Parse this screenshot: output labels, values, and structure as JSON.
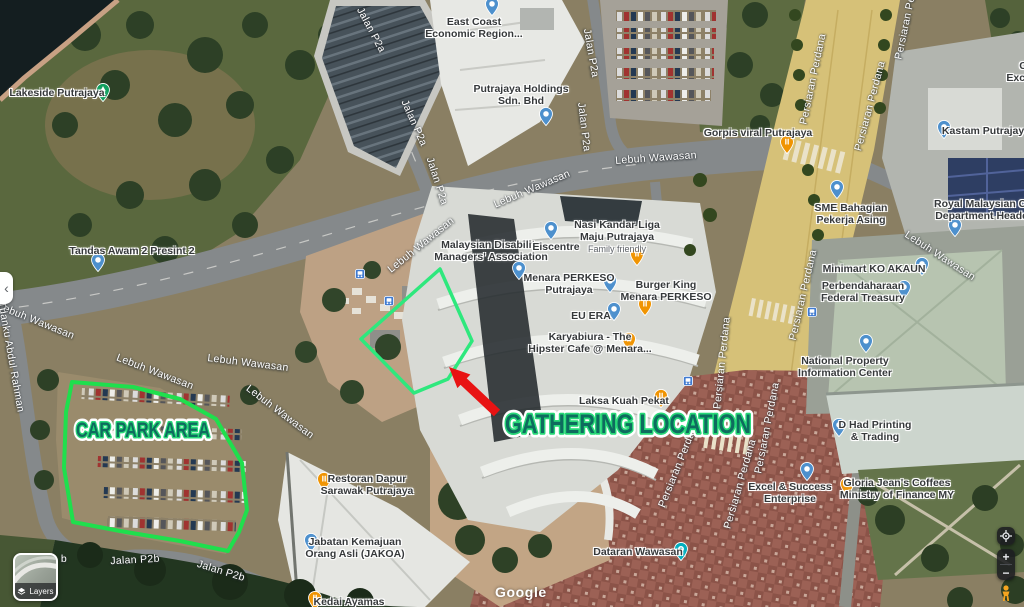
{
  "attribution": {
    "watermark": "Google"
  },
  "controls": {
    "layers": {
      "label": "Layers"
    },
    "collapse_glyph": "‹",
    "zoom_in_label": "+",
    "zoom_out_label": "−"
  },
  "annotations": {
    "car_park_label": "CAR PARK AREA",
    "gathering_label": "GATHERING LOCATION",
    "colors": {
      "car_park_outline": "#1fdf4d",
      "gathering_outline": "#2ee87d",
      "arrow_red": "#e81313",
      "label_fill": "#0e6b5e",
      "label_stroke": "#27d877"
    }
  },
  "map": {
    "pois": [
      {
        "name": "lakeside-putrajaya",
        "lines": [
          "Lakeside Putrajaya"
        ],
        "x": 57,
        "y": 87,
        "pin": "tree",
        "pin_x": 103,
        "pin_y": 94
      },
      {
        "name": "tandas-awam-2-presint-2",
        "lines": [
          "Tandas Awam 2 Presint 2"
        ],
        "x": 132,
        "y": 245,
        "pin": "blue",
        "pin_x": 98,
        "pin_y": 264
      },
      {
        "name": "east-coast-economic-region",
        "lines": [
          "East Coast",
          "Economic Region..."
        ],
        "x": 474,
        "y": 16,
        "pin": "blue",
        "pin_x": 492,
        "pin_y": 8
      },
      {
        "name": "putrajaya-holdings",
        "lines": [
          "Putrajaya Holdings",
          "Sdn. Bhd"
        ],
        "x": 521,
        "y": 83,
        "pin": "blue",
        "pin_x": 546,
        "pin_y": 118
      },
      {
        "name": "gorpis-viral-putrajaya",
        "lines": [
          "Gorpis viral Putrajaya"
        ],
        "x": 758,
        "y": 127,
        "pin": "food",
        "pin_x": 787,
        "pin_y": 146
      },
      {
        "name": "sme-bahagian-pekerja-asing",
        "lines": [
          "SME Bahagian",
          "Pekerja Asing"
        ],
        "x": 851,
        "y": 202,
        "pin": "blue",
        "pin_x": 837,
        "pin_y": 191
      },
      {
        "name": "kastam-putrajaya",
        "lines": [
          "Kastam Putrajaya"
        ],
        "x": 986,
        "y": 125,
        "pin": "blue",
        "pin_x": 944,
        "pin_y": 131
      },
      {
        "name": "excise-partial",
        "lines": [
          "C",
          "Excise"
        ],
        "x": 1023,
        "y": 60,
        "pin": ""
      },
      {
        "name": "royal-malaysian-customs",
        "lines": [
          "Royal Malaysian Cust",
          "Department Headqua"
        ],
        "x": 988,
        "y": 198,
        "pin": "blue",
        "pin_x": 955,
        "pin_y": 229
      },
      {
        "name": "minimart-ko-akaun",
        "lines": [
          "Minimart KO AKAUN"
        ],
        "x": 874,
        "y": 263,
        "pin": "blue",
        "pin_x": 922,
        "pin_y": 268
      },
      {
        "name": "perbendaharaan-federal-treasury",
        "lines": [
          "Perbendaharaan",
          "Federal Treasury"
        ],
        "x": 863,
        "y": 280,
        "pin": "blue",
        "pin_x": 904,
        "pin_y": 291
      },
      {
        "name": "national-property-information-center",
        "lines": [
          "National Property",
          "Information Center"
        ],
        "x": 845,
        "y": 355,
        "pin": "blue",
        "pin_x": 866,
        "pin_y": 345
      },
      {
        "name": "malaysian-disability-managers-association",
        "lines": [
          "Malaysian Disability",
          "Managers' Association"
        ],
        "x": 491,
        "y": 239,
        "pin": "blue",
        "pin_x": 519,
        "pin_y": 272
      },
      {
        "name": "eiscentre",
        "lines": [
          "Eiscentre"
        ],
        "x": 556,
        "y": 241,
        "pin": "blue",
        "pin_x": 551,
        "pin_y": 232
      },
      {
        "name": "nasi-kandar-liga-maju-putrajaya",
        "lines": [
          "Nasi Kandar Liga",
          "Maju Putrajaya"
        ],
        "sub": "Family friendly",
        "x": 617,
        "y": 219,
        "pin": "food",
        "pin_x": 637,
        "pin_y": 258
      },
      {
        "name": "menara-perkeso-putrajaya",
        "lines": [
          "Menara PERKESO",
          "Putrajaya"
        ],
        "x": 569,
        "y": 272,
        "pin": "blue",
        "pin_x": 610,
        "pin_y": 285
      },
      {
        "name": "burger-king-menara-perkeso",
        "lines": [
          "Burger King",
          "Menara PERKESO"
        ],
        "x": 666,
        "y": 279,
        "pin": "food",
        "pin_x": 645,
        "pin_y": 308
      },
      {
        "name": "eu-era",
        "lines": [
          "EU ERA"
        ],
        "x": 591,
        "y": 310,
        "pin": "blue",
        "pin_x": 614,
        "pin_y": 313
      },
      {
        "name": "karyabiura-hipster-cafe",
        "lines": [
          "Karyabiura - The",
          "Hipster Cafe @ Menara..."
        ],
        "x": 590,
        "y": 331,
        "pin": "food",
        "pin_x": 629,
        "pin_y": 343
      },
      {
        "name": "laksa-kuah-pekat",
        "lines": [
          "Laksa Kuah Pekat"
        ],
        "x": 624,
        "y": 395,
        "pin": "food",
        "pin_x": 661,
        "pin_y": 400
      },
      {
        "name": "dataran-wawasan",
        "lines": [
          "Dataran Wawasan"
        ],
        "x": 638,
        "y": 546,
        "pin": "camera",
        "pin_x": 681,
        "pin_y": 553
      },
      {
        "name": "restoran-dapur-sarawak-putrajaya",
        "lines": [
          "Restoran Dapur",
          "Sarawak Putrajaya"
        ],
        "x": 367,
        "y": 473,
        "pin": "food",
        "pin_x": 324,
        "pin_y": 483
      },
      {
        "name": "jabatan-kemajuan-orang-asli-jakoa",
        "lines": [
          "Jabatan Kemajuan",
          "Orang Asli (JAKOA)"
        ],
        "x": 355,
        "y": 536,
        "pin": "blue",
        "pin_x": 311,
        "pin_y": 544
      },
      {
        "name": "kedai-ayamas",
        "lines": [
          "Kedai Ayamas"
        ],
        "x": 349,
        "y": 596,
        "pin": "food",
        "pin_x": 315,
        "pin_y": 602
      },
      {
        "name": "excel-success-enterprise",
        "lines": [
          "Excel & Success",
          "Enterprise"
        ],
        "x": 790,
        "y": 481,
        "pin": "blue",
        "pin_x": 807,
        "pin_y": 473
      },
      {
        "name": "gloria-jeans-coffees-ministry-of-finance",
        "lines": [
          "Gloria Jean's Coffees",
          "Ministry of Finance MY"
        ],
        "x": 897,
        "y": 477,
        "pin": "food",
        "pin_x": 847,
        "pin_y": 488
      },
      {
        "name": "d-had-printing-trading",
        "lines": [
          "D Had Printing",
          "& Trading"
        ],
        "x": 875,
        "y": 419,
        "pin": "blue",
        "pin_x": 839,
        "pin_y": 429
      }
    ],
    "road_labels": [
      {
        "text": "Jalan P2a",
        "x": 371,
        "y": 30,
        "rot": 62
      },
      {
        "text": "Jalan P2a",
        "x": 414,
        "y": 123,
        "rot": 66
      },
      {
        "text": "Jalan P2a",
        "x": 437,
        "y": 181,
        "rot": 72
      },
      {
        "text": "Jalan P2a",
        "x": 591,
        "y": 53,
        "rot": 80
      },
      {
        "text": "Jalan P2a",
        "x": 584,
        "y": 127,
        "rot": 83
      },
      {
        "text": "Lebuh Wawasan",
        "x": 36,
        "y": 321,
        "rot": 22
      },
      {
        "text": "Lebuh Wawasan",
        "x": 155,
        "y": 372,
        "rot": 21
      },
      {
        "text": "Lebuh Wawasan",
        "x": 248,
        "y": 363,
        "rot": 7
      },
      {
        "text": "Lebuh Wawasan",
        "x": 280,
        "y": 412,
        "rot": 37
      },
      {
        "text": "Lebuh Wawasan",
        "x": 421,
        "y": 245,
        "rot": -39
      },
      {
        "text": "Lebuh Wawasan",
        "x": 532,
        "y": 189,
        "rot": -23
      },
      {
        "text": "Lebuh Wawasan",
        "x": 656,
        "y": 158,
        "rot": -4
      },
      {
        "text": "Lebuh Wawasan",
        "x": 940,
        "y": 256,
        "rot": 33
      },
      {
        "text": "Persiaran Perdana",
        "x": 813,
        "y": 79,
        "rot": -78
      },
      {
        "text": "Persiaran Perdana",
        "x": 870,
        "y": 106,
        "rot": -75
      },
      {
        "text": "Persiaran Perdana",
        "x": 908,
        "y": 14,
        "rot": -78
      },
      {
        "text": "Persiaran Perdana",
        "x": 803,
        "y": 295,
        "rot": -77
      },
      {
        "text": "Persiaran Perdana",
        "x": 722,
        "y": 363,
        "rot": -84
      },
      {
        "text": "Persiaran Perdana",
        "x": 679,
        "y": 464,
        "rot": -68
      },
      {
        "text": "Persiaran Perdana",
        "x": 740,
        "y": 484,
        "rot": -74
      },
      {
        "text": "Persiaran Perdana",
        "x": 767,
        "y": 428,
        "rot": -79
      },
      {
        "text": "Tuanku Abdul Rahman",
        "x": 11,
        "y": 357,
        "rot": 80
      },
      {
        "text": "Jalan P2b",
        "x": 135,
        "y": 560,
        "rot": -3
      },
      {
        "text": "Jalan P2b",
        "x": 221,
        "y": 571,
        "rot": 17
      },
      {
        "text": "b",
        "x": 64,
        "y": 559,
        "rot": 0
      }
    ],
    "transit_stops": [
      {
        "x": 360,
        "y": 274
      },
      {
        "x": 389,
        "y": 301
      },
      {
        "x": 688,
        "y": 381
      },
      {
        "x": 812,
        "y": 312
      }
    ]
  }
}
